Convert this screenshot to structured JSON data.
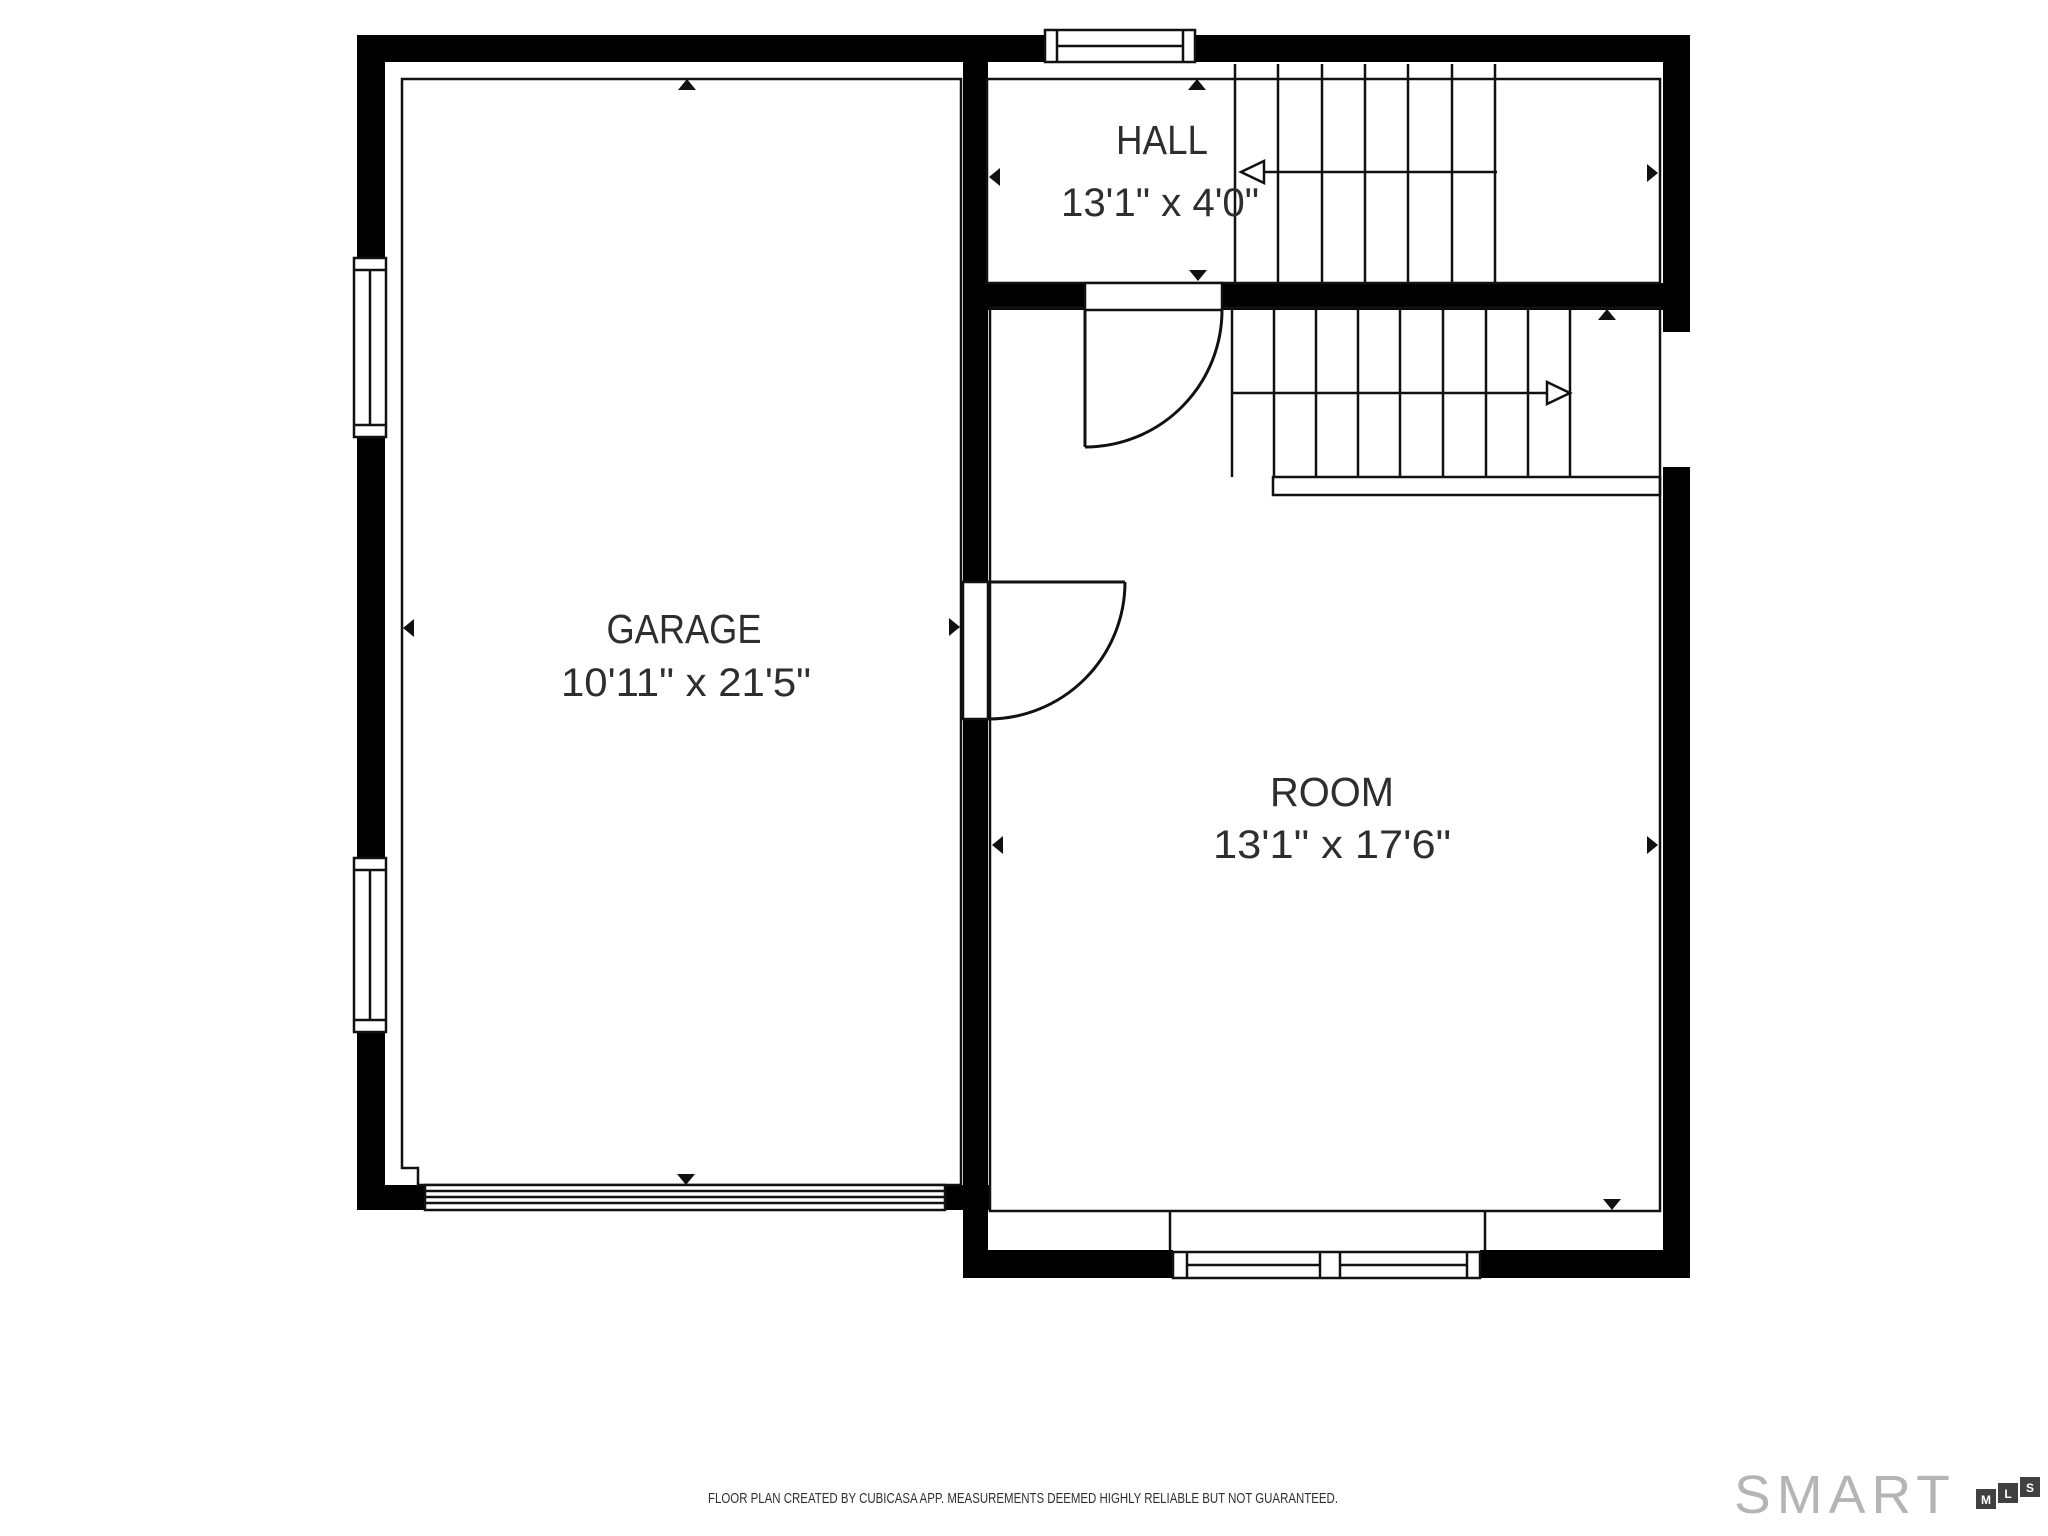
{
  "rooms": [
    {
      "name": "GARAGE",
      "dimensions": "10'11\" x 21'5\""
    },
    {
      "name": "HALL",
      "dimensions": "13'1\" x 4'0\""
    },
    {
      "name": "ROOM",
      "dimensions": "13'1\" x 17'6\""
    }
  ],
  "footer": {
    "disclaimer": "FLOOR PLAN CREATED BY CUBICASA APP. MEASUREMENTS DEEMED HIGHLY RELIABLE BUT NOT GUARANTEED."
  },
  "logo": {
    "brand": "SMART",
    "boxes": [
      "M",
      "L",
      "S"
    ]
  },
  "colors": {
    "wall": "#000000",
    "line": "#111111",
    "label_text": "#2e2e2e",
    "footer_text": "#303030",
    "logo_gray": "#b5b5b5",
    "logo_box": "#414141"
  }
}
